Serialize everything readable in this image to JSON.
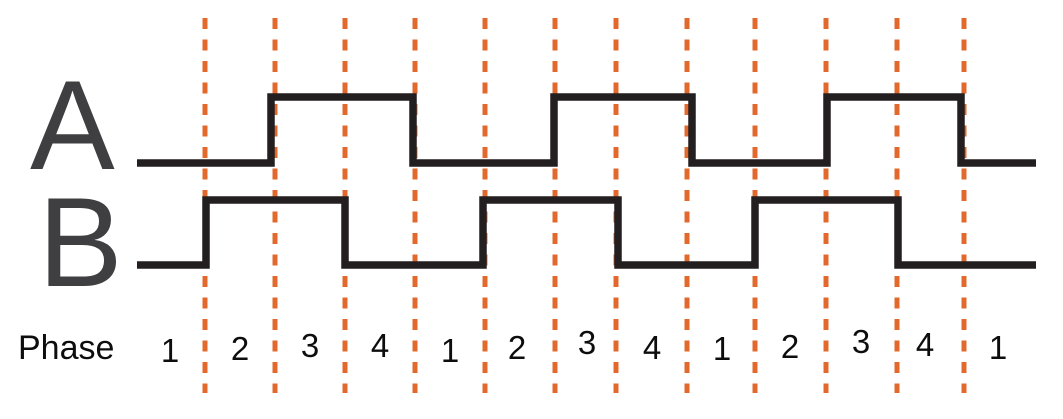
{
  "diagram_type": "quadrature-encoder-timing-diagram",
  "colors": {
    "background": "#ffffff",
    "signal_stroke": "#231f20",
    "signal_letter": "#3f3f41",
    "phase_text": "#0d0d0d",
    "phase_boundary_orange": "#e2682c"
  },
  "signals": [
    {
      "name": "A",
      "start_x": 137,
      "end_x": 1036,
      "initial_level": "low",
      "low_y": 163,
      "high_y": 97,
      "transitions_x": [
        271,
        413,
        554,
        692,
        827,
        961
      ],
      "stroke_width": 7.5
    },
    {
      "name": "B",
      "start_x": 137,
      "end_x": 1036,
      "initial_level": "low",
      "low_y": 265,
      "high_y": 200,
      "transitions_x": [
        206,
        345,
        483,
        618,
        755,
        898
      ],
      "stroke_width": 7.5
    }
  ],
  "dashed_lines": {
    "x": [
      205,
      275,
      345,
      415,
      485,
      555,
      616,
      687,
      755,
      826,
      897,
      964
    ],
    "top_y": 18,
    "bottom_y": 393,
    "stroke_width": 5,
    "dash_length": 11,
    "gap_length": 10.5
  },
  "phase_row": {
    "label": "Phase",
    "labels": [
      {
        "text": "1",
        "x": 170,
        "dy": 3
      },
      {
        "text": "2",
        "x": 240,
        "dy": 1
      },
      {
        "text": "3",
        "x": 310,
        "dy": -2
      },
      {
        "text": "4",
        "x": 380,
        "dy": -2
      },
      {
        "text": "1",
        "x": 450,
        "dy": 3
      },
      {
        "text": "2",
        "x": 517,
        "dy": 0
      },
      {
        "text": "3",
        "x": 587,
        "dy": -5
      },
      {
        "text": "4",
        "x": 652,
        "dy": 0
      },
      {
        "text": "1",
        "x": 722,
        "dy": 1
      },
      {
        "text": "2",
        "x": 790,
        "dy": -1
      },
      {
        "text": "3",
        "x": 861,
        "dy": -6
      },
      {
        "text": "4",
        "x": 925,
        "dy": -3
      },
      {
        "text": "1",
        "x": 998,
        "dy": 0
      }
    ]
  }
}
